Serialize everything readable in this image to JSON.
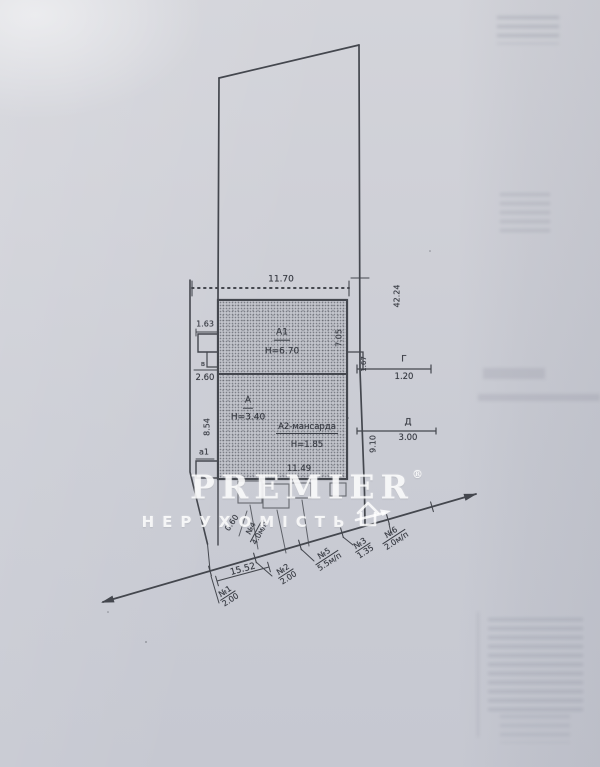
{
  "colors": {
    "paper": "#cdcfd6",
    "ink": "#3f424a",
    "building_fill": "#c2c4cb",
    "watermark": "#ffffff"
  },
  "watermark": {
    "brand": "PREMIER",
    "registered_mark": "®",
    "subtitle": "НЕРУХОМІСТЬ",
    "icon": "house-with-arrow-icon"
  },
  "plan": {
    "parcel": {
      "front_width": "11.70",
      "side_length": "42.24"
    },
    "building": {
      "a1_label": "А1",
      "a1_height": "Н=6.70",
      "a1_depth": "7.05",
      "a_label": "А",
      "a_height": "Н=3.40",
      "a2_label": "А2-мансарда",
      "a2_height": "Н=1.85",
      "a_width": "11.49"
    },
    "left_side": {
      "porch_width": "1.63",
      "porch_label": "в",
      "porch_depth": "2.60",
      "wall_length": "8.54",
      "annex_label": "а1"
    },
    "right_side": {
      "g_label": "Г",
      "g_length": "1.20",
      "g_offset": "1.67",
      "d_label": "Д",
      "d_length": "3.00",
      "d_offset": "9.10"
    },
    "frontage": {
      "offset": "0.60",
      "total": "15.52",
      "f4_no": "№4",
      "f4_val": "4.0м/п",
      "f1_no": "№1",
      "f1_val": "2.00",
      "f2_no": "№2",
      "f2_val": "2.00",
      "f5_no": "№5",
      "f5_val": "5.5м/п",
      "f3_no": "№3",
      "f3_val": "1.35",
      "f6_no": "№6",
      "f6_val": "2.0м/п"
    }
  }
}
